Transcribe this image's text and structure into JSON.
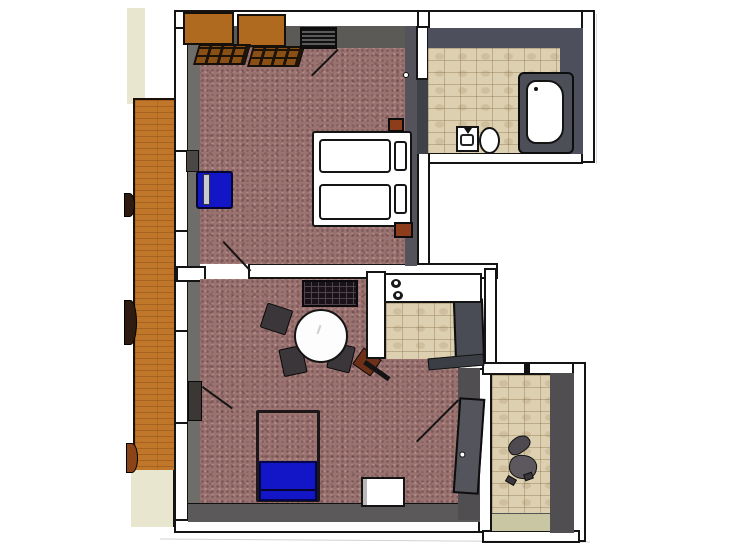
{
  "scene": {
    "type": "3d-floorplan-top-view",
    "style": "sketchup-render",
    "description": "Top-down 3D rendering of a small apartment floor plan with bedroom, bathroom, living room with kitchen nook, entry hall and balcony strip"
  },
  "palette": {
    "canvas": "#ffffff",
    "wall-white": "#ffffff",
    "outline": "#141414",
    "face-dark": "#54525a",
    "face-mid": "#6f6d69",
    "face-top": "#5c5a57",
    "face-bath": "#4d505c",
    "face-bottom": "#5c595b",
    "face-hall": "#514e52",
    "carpet": "#9a7270",
    "tile": "#ddd0b0",
    "wood": "#c1772a",
    "wardrobe-top": "#b06a1f",
    "wardrobe-front": "#8a4f14",
    "nightstand": "#8e3d1c",
    "blue": "#1216c6",
    "blue-edge": "#05054a",
    "chair-dark": "#3a363a",
    "grid-dark": "#191219",
    "grid-line": "#4d434a",
    "door-gray": "#54545c",
    "unit-gray": "#4a4c55",
    "tub-rim": "#4c4f57",
    "balcony-beige": "#e9e6d0",
    "hall-mat": "#c9c6a4",
    "planter-dark": "#2e1c10",
    "planter-brown": "#8a4418",
    "office-chair": "#5c585e"
  },
  "rooms": [
    {
      "id": "bedroom",
      "floor": "carpet",
      "furniture": [
        "wardrobe",
        "wardrobe",
        "window-radiator",
        "double-bed",
        "mattress",
        "mattress",
        "pillow",
        "pillow",
        "nightstand",
        "nightstand",
        "blue-armchair",
        "door-to-bathroom",
        "door-swing"
      ]
    },
    {
      "id": "bathroom",
      "floor": "tiles",
      "furniture": [
        "bathtub",
        "sink",
        "toilet"
      ]
    },
    {
      "id": "living-room",
      "floor": "carpet",
      "furniture": [
        "grid-shelf",
        "round-dining-table",
        "dining-chair",
        "dining-chair",
        "dining-chair",
        "dining-chair-brown",
        "sofa-bed-blue",
        "white-stool",
        "balcony-door",
        "entry-door-open"
      ]
    },
    {
      "id": "kitchen-nook",
      "floor": "tiles",
      "furniture": [
        "counter",
        "cooktop-burner",
        "cooktop-burner",
        "tall-cabinet"
      ]
    },
    {
      "id": "entry-hall",
      "floor": "tiles",
      "furniture": [
        "office-chair",
        "doormat"
      ]
    },
    {
      "id": "balcony",
      "floor": "wood",
      "furniture": [
        "planter",
        "planter",
        "planter"
      ]
    }
  ]
}
